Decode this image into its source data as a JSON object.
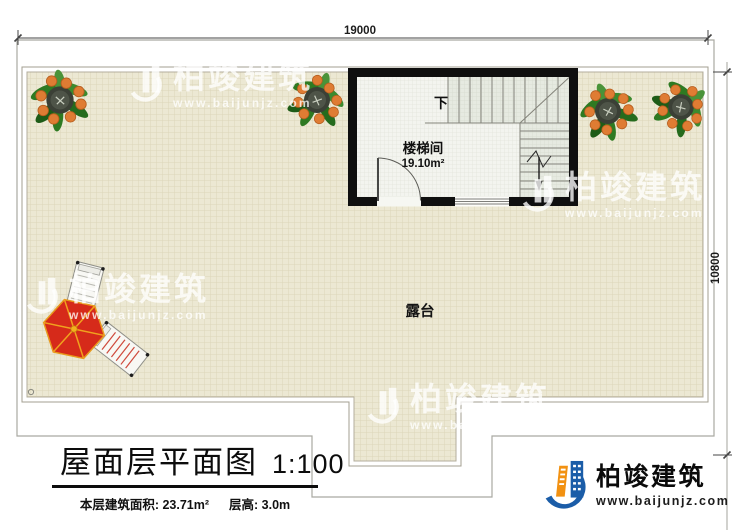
{
  "dimensions": {
    "top": "19000",
    "right": "10800"
  },
  "stair_room": {
    "name": "楼梯间",
    "area": "19.10m²",
    "direction": "下"
  },
  "terrace": {
    "name": "露台"
  },
  "title_block": {
    "title": "屋面层平面图",
    "scale": "1:100",
    "area_info": "本层建筑面积: 23.71m²",
    "height_info": "层高: 3.0m"
  },
  "brand": {
    "name": "柏竣建筑",
    "url": "www.baijunjz.com"
  },
  "colors": {
    "wall": "#0f0f0f",
    "terrace_bg": "#ece8d3",
    "accent_blue": "#1b5da8",
    "accent_orange": "#f29111",
    "umbrella_red": "#d62a1a"
  }
}
